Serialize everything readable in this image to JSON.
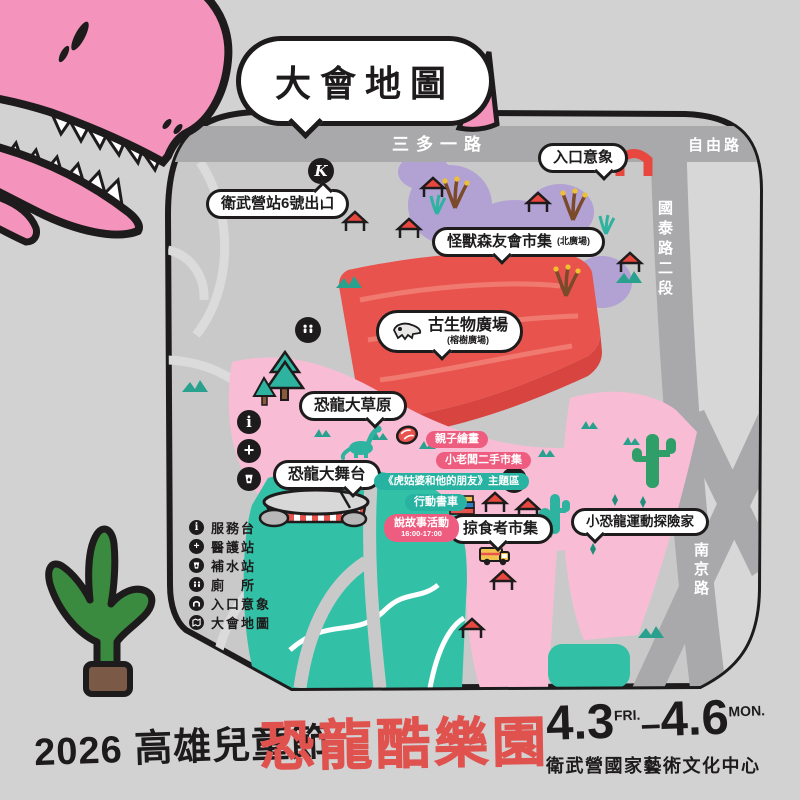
{
  "colors": {
    "background": "#d3d2d3",
    "map_fill": "#cac9ca",
    "road_gray": "#a9a8aa",
    "pink_zone": "#f8bdd5",
    "dino_pink": "#f493bb",
    "pond_teal": "#32c1a7",
    "plaza_red": "#e8534e",
    "market_purple": "#b2a1d3",
    "pill_pink": "#ee5d7f",
    "pill_teal": "#28b2a2",
    "ink": "#1d1b1b"
  },
  "title_bubble": "大會地圖",
  "roads": {
    "sanduo_rd": "三多一路",
    "ziyou_rd": "自由路",
    "guotai_rd": "國泰路二段",
    "nanjing_rd": "南京路"
  },
  "stations": {
    "metro_exit": "衛武營站6號出口",
    "metro_badge": "K"
  },
  "areas": {
    "entrance": "入口意象",
    "monster_market": "怪獸森友會市集",
    "monster_market_sub": "(北廣場)",
    "paleo_plaza": "古生物廣場",
    "paleo_plaza_sub": "(榕樹廣場)",
    "dino_meadow": "恐龍大草原",
    "dino_stage": "恐龍大舞台",
    "predator_market": "掠食者市集",
    "little_dino_camp": "小恐龍運動探險家"
  },
  "activities": {
    "parent_child_paint": "親子繪畫",
    "kid_boss_market": "小老闆二手市集",
    "tiger_aunt_theme": "《虎姑婆和他的朋友》主題區",
    "book_truck": "行動書車",
    "storytelling": "說故事活動",
    "storytelling_time": "16:00-17:00"
  },
  "legend": {
    "items": [
      {
        "icon": "info-icon",
        "label": "服務台"
      },
      {
        "icon": "medical-icon",
        "label": "醫護站"
      },
      {
        "icon": "water-icon",
        "label": "補水站"
      },
      {
        "icon": "restroom-icon",
        "label": "廁　所"
      },
      {
        "icon": "arch-icon",
        "label": "入口意象"
      },
      {
        "icon": "map-icon",
        "label": "大會地圖"
      }
    ]
  },
  "footer": {
    "event": "2026 高雄兒童節",
    "title": "恐龍酷樂園",
    "date_start": "4.3",
    "date_start_day": "FRI.",
    "date_separator": "–",
    "date_end": "4.6",
    "date_end_day": "MON.",
    "venue": "衛武營國家藝術文化中心"
  }
}
